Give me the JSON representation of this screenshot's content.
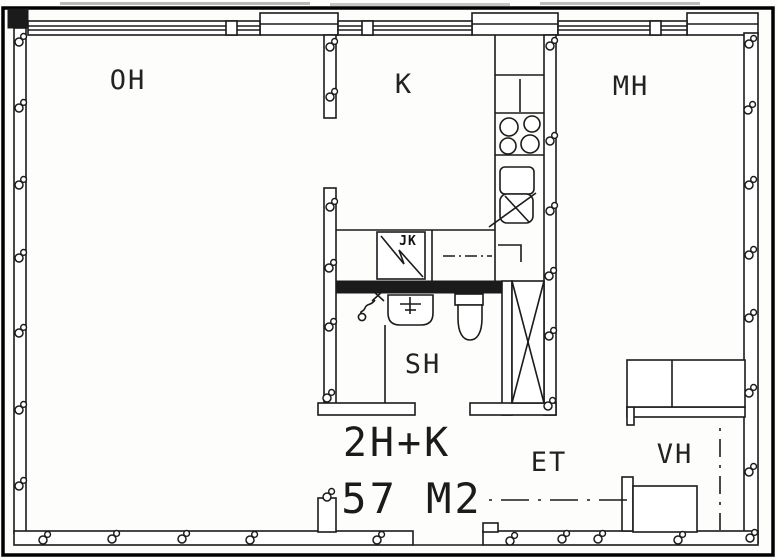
{
  "floorplan": {
    "apartment": {
      "layout_code": "2H+K",
      "area_label": "57 M2"
    },
    "rooms": {
      "oh": {
        "label": "OH"
      },
      "k": {
        "label": "K"
      },
      "mh": {
        "label": "MH"
      },
      "sh": {
        "label": "SH"
      },
      "et": {
        "label": "ET"
      },
      "vh": {
        "label": "VH"
      }
    },
    "appliances": {
      "jk": {
        "label": "JK"
      }
    },
    "colors": {
      "line": "#1b1b1b",
      "background": "#fdfdfb",
      "wall_fill": "#ffffff"
    }
  }
}
